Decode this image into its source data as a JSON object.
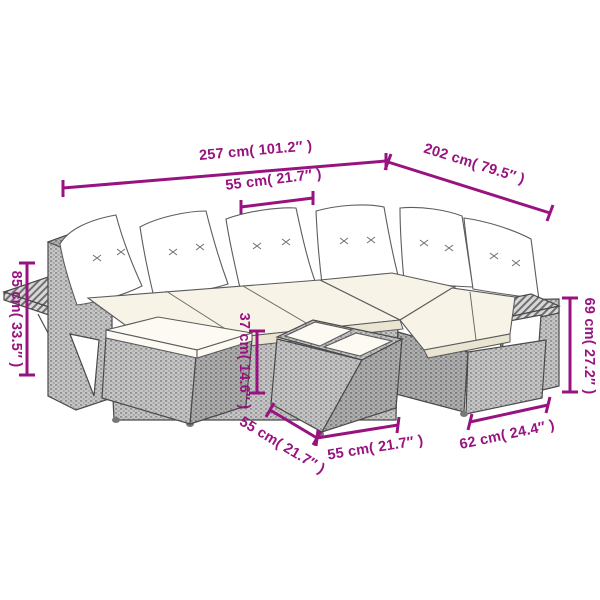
{
  "meta": {
    "kind": "product-dimension-diagram",
    "subject": "poly rattan garden corner sofa set with cushions, footstool and table"
  },
  "colors": {
    "background": "#ffffff",
    "dimension_annotation": "#98137F",
    "line_art": "#4a4a4a",
    "wicker_light": "#c7c7c7",
    "wicker_dark": "#b0b0b0",
    "cushion_white": "#ffffff",
    "seat_cream": "#f7f3e6"
  },
  "dims": {
    "overall_width": {
      "cm": "257",
      "inches": "101.2",
      "label": "257 cm( 101.2″ )"
    },
    "overall_depth": {
      "cm": "202",
      "inches": "79.5",
      "label": "202 cm( 79.5″ )"
    },
    "seat_width": {
      "cm": "55",
      "inches": "21.7",
      "label": "55 cm( 21.7″ )"
    },
    "overall_height": {
      "cm": "85",
      "inches": "33.5",
      "label": "85 cm( 33.5″ )"
    },
    "table_height": {
      "cm": "37",
      "inches": "14.6",
      "label": "37 cm( 14.6″ )"
    },
    "arm_height": {
      "cm": "69",
      "inches": "27.2",
      "label": "69 cm( 27.2″ )"
    },
    "table_depth": {
      "cm": "55",
      "inches": "21.7",
      "label": "55 cm( 21.7″ )"
    },
    "table_width": {
      "cm": "55",
      "inches": "21.7",
      "label": "55 cm( 21.7″ )"
    },
    "seat_depth": {
      "cm": "62",
      "inches": "24.4",
      "label": "62 cm( 24.4″ )"
    }
  }
}
